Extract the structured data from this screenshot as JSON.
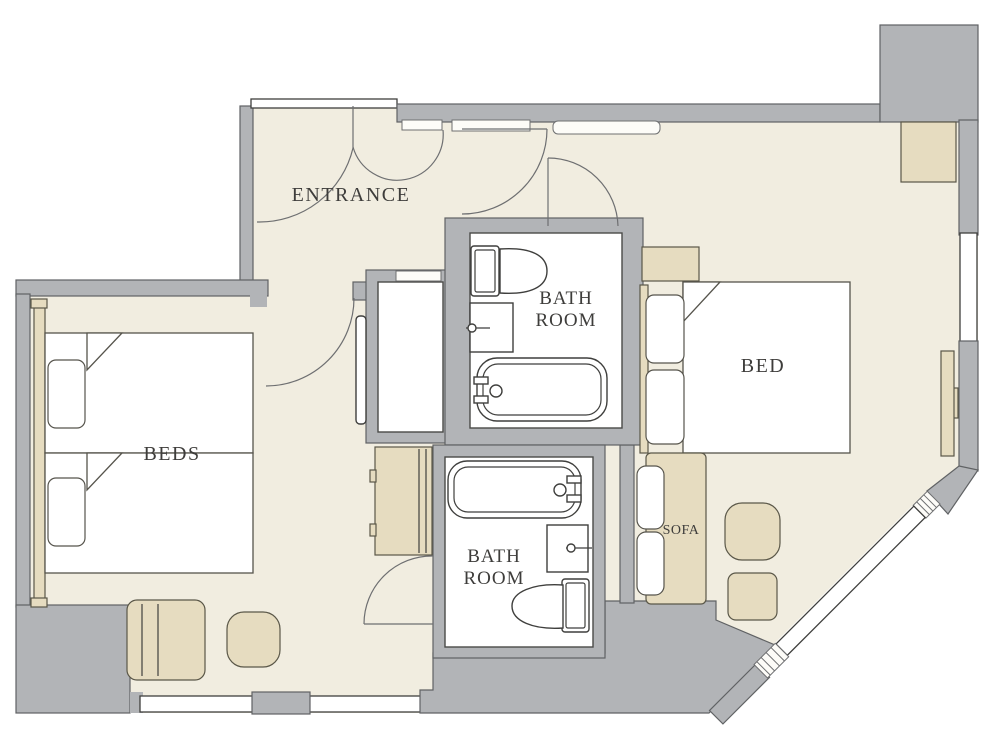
{
  "image_type": "architectural floor plan of a hotel suite",
  "labels": {
    "entrance": "ENTRANCE",
    "bath_top": {
      "line1": "BATH",
      "line2": "ROOM"
    },
    "bath_bottom": {
      "line1": "BATH",
      "line2": "ROOM"
    },
    "beds_room": "BEDS",
    "bed_room": "BED",
    "sofa": "SOFA"
  },
  "colors": {
    "wall_fill": "#b2b4b7",
    "wall_outline": "#606264",
    "floor": "#f1ede0",
    "furniture_fill": "#e6dcc0",
    "furniture_outline": "#5a5748",
    "fixture_outline": "#3f3f3d",
    "label_text": "#3e3d3b",
    "exterior": "#ffffff"
  }
}
